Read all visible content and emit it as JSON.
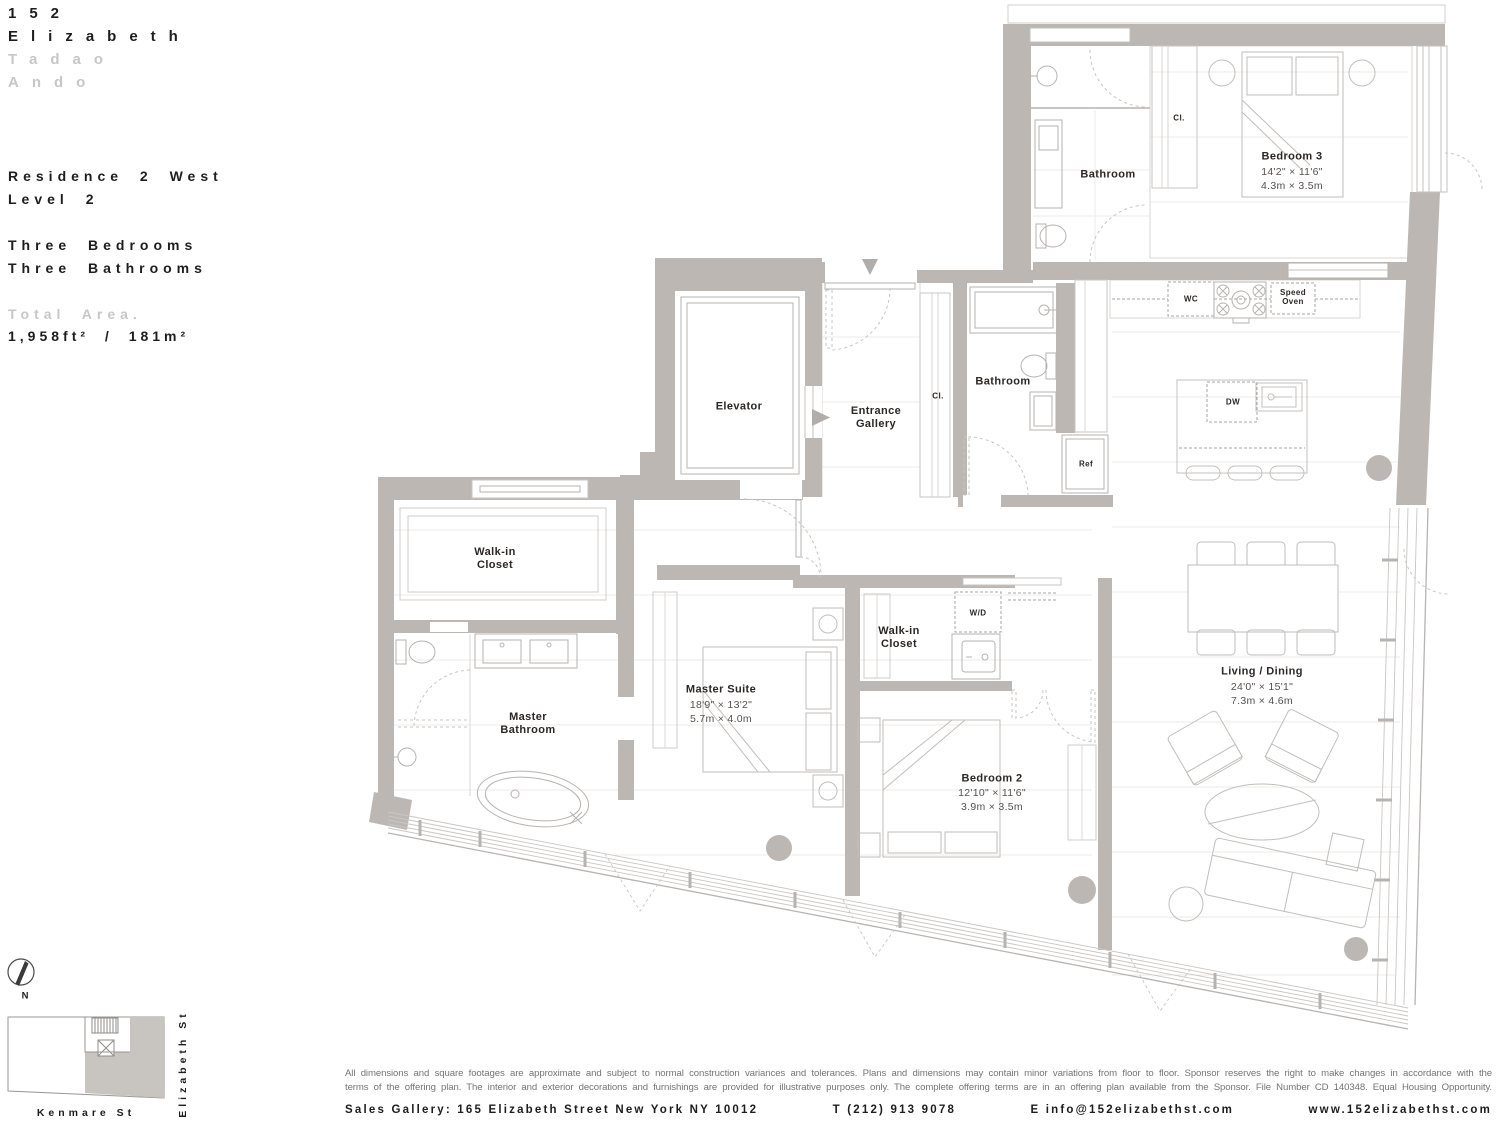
{
  "brand": {
    "address_number": "152",
    "address_name": "Elizabeth",
    "architect_first": "Tadao",
    "architect_last": "Ando"
  },
  "residence": {
    "name": "Residence 2 West",
    "level": "Level 2",
    "bedrooms": "Three Bedrooms",
    "bathrooms": "Three Bathrooms",
    "total_area_label": "Total Area.",
    "total_area_value": "1,958ft² / 181m²"
  },
  "rooms": {
    "bedroom3": {
      "name": "Bedroom 3",
      "imperial": "14'2\" × 11'6\"",
      "metric": "4.3m × 3.5m"
    },
    "bathroom_top": {
      "name": "Bathroom"
    },
    "cl_top": {
      "name": "Cl."
    },
    "elevator": {
      "name": "Elevator"
    },
    "entrance_gallery": {
      "name": "Entrance Gallery"
    },
    "cl_entry": {
      "name": "Cl."
    },
    "bathroom_mid": {
      "name": "Bathroom"
    },
    "ref": {
      "name": "Ref"
    },
    "wc": {
      "name": "WC"
    },
    "speed_oven": {
      "name": "Speed Oven"
    },
    "dw": {
      "name": "DW"
    },
    "wd": {
      "name": "W/D"
    },
    "walkin_master": {
      "name": "Walk-in Closet"
    },
    "master_bathroom": {
      "name": "Master Bathroom"
    },
    "master_suite": {
      "name": "Master Suite",
      "imperial": "18'9\" × 13'2\"",
      "metric": "5.7m × 4.0m"
    },
    "walkin_2": {
      "name": "Walk-in Closet"
    },
    "bedroom2": {
      "name": "Bedroom 2",
      "imperial": "12'10\" × 11'6\"",
      "metric": "3.9m × 3.5m"
    },
    "living_dining": {
      "name": "Living / Dining",
      "imperial": "24'0\" × 15'1\"",
      "metric": "7.3m × 4.6m"
    }
  },
  "site": {
    "north_label": "N",
    "street_south": "Kenmare St",
    "street_east": "Elizabeth St"
  },
  "footer": {
    "disclaimer_line1": "All dimensions and square footages are approximate and subject to normal construction variances and tolerances. Plans and dimensions may contain minor variations from floor to floor. Sponsor reserves the right to make changes in accordance with the",
    "disclaimer_line2": "terms of the offering plan. The interior and exterior decorations and furnishings are provided for illustrative purposes only. The complete offering terms are in an offering plan available from the Sponsor. File Number CD 140348. Equal Housing Opportunity.",
    "sales_segments": [
      "Sales Gallery: 165 Elizabeth Street New York NY 10012",
      "T (212) 913 9078",
      "E info@152elizabethst.com",
      "www.152elizabethst.com"
    ]
  }
}
